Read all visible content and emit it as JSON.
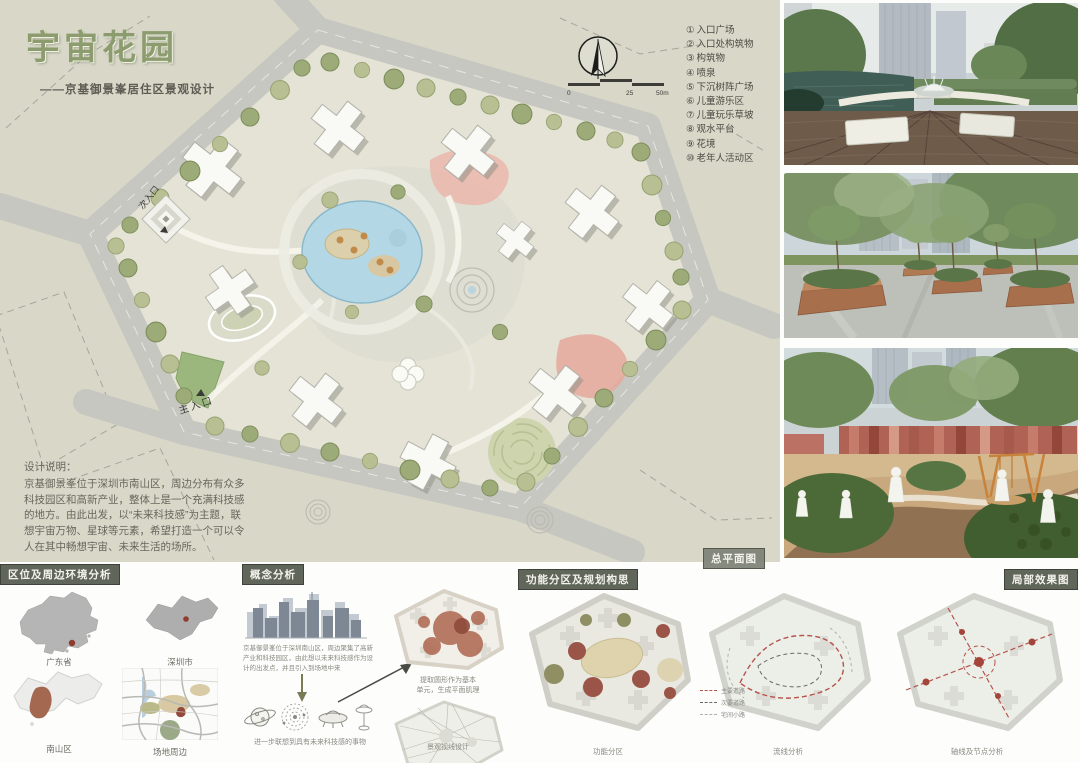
{
  "header": {
    "title": "宇宙花园",
    "subtitle": "——京基御景峯居住区景观设计"
  },
  "masterplan": {
    "label": "总平面图",
    "entrance_secondary": "次入口",
    "entrance_main": "主入口",
    "scale_ticks": [
      "0",
      "25",
      "50m"
    ],
    "legend": [
      {
        "num": "①",
        "label": "入口广场"
      },
      {
        "num": "②",
        "label": "入口处构筑物"
      },
      {
        "num": "③",
        "label": "构筑物"
      },
      {
        "num": "④",
        "label": "喷泉"
      },
      {
        "num": "⑤",
        "label": "下沉树阵广场"
      },
      {
        "num": "⑥",
        "label": "儿童游乐区"
      },
      {
        "num": "⑦",
        "label": "儿童玩乐草坡"
      },
      {
        "num": "⑧",
        "label": "观水平台"
      },
      {
        "num": "⑨",
        "label": "花境"
      },
      {
        "num": "⑩",
        "label": "老年人活动区"
      }
    ]
  },
  "design_notes": {
    "heading": "设计说明：",
    "body": "京基御景峯位于深圳市南山区，周边分布有众多科技园区和高新产业，整体上是一个充满科技感的地方。由此出发，以“未来科技感”为主题，联想宇宙万物、星球等元素，希望打造一个可以令人在其中畅想宇宙、未来生活的场所。"
  },
  "section_headers": {
    "location": "区位及周边环境分析",
    "concept": "概念分析",
    "planning": "功能分区及规划构思",
    "detail_views": "局部效果图"
  },
  "location_maps": {
    "captions": [
      "广东省",
      "深圳市",
      "南山区",
      "场地周边"
    ]
  },
  "concept": {
    "paragraph": "京基御景峯位于深圳南山区，周边聚集了高新产业和科技园区，由此想以未来科技感作为设计的出发点，并且引入到场地中来",
    "sketch_caption": "进一步联想到具有未来科技感的事物",
    "transform_caption_line1": "提取圆形作为基本",
    "transform_caption_line2": "单元，生成平面肌理",
    "sightline_caption": "景观视线设计"
  },
  "analysis_diagrams": {
    "captions": [
      "功能分区",
      "流线分析",
      "轴线及节点分析"
    ],
    "flow_legend": [
      "主要道路",
      "次要道路",
      "宅间小路"
    ]
  },
  "colors": {
    "board_bg": "#d8d7c8",
    "accent_green": "#8c9c6e",
    "ribbon": "#61665a",
    "water": "#b4d7e5",
    "maroon": "#9b5548",
    "brick": "#a86f4c"
  }
}
